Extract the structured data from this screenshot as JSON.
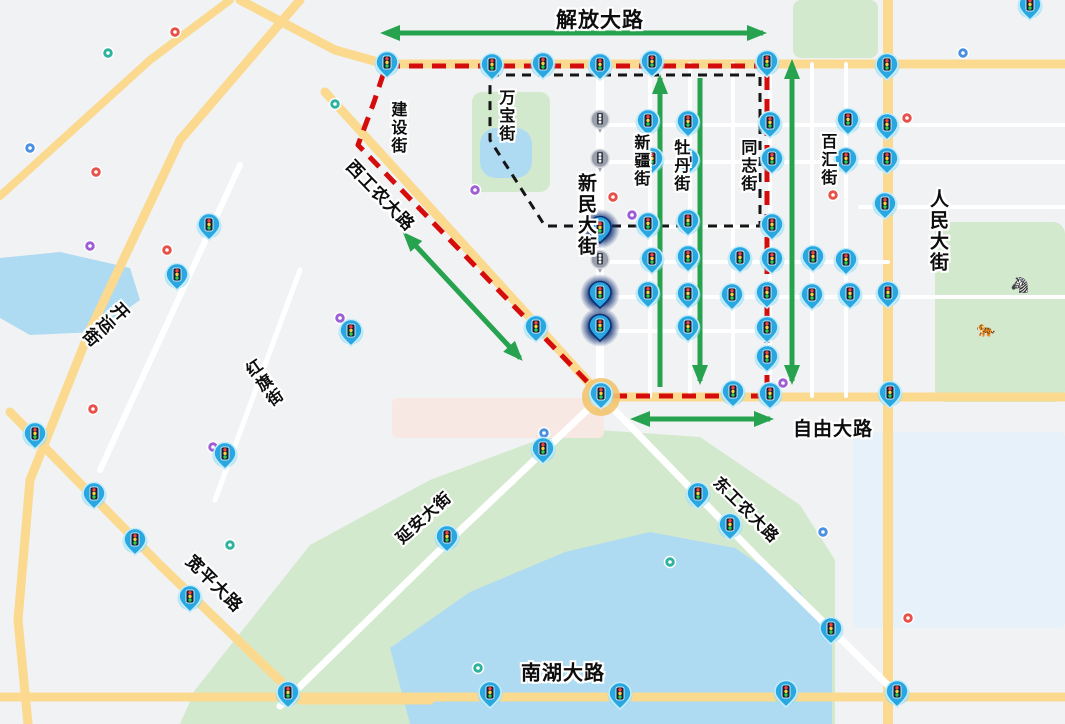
{
  "map": {
    "colors": {
      "bg": "#f1f2f4",
      "road_yellow": "#fbd98f",
      "road_white": "#ffffff",
      "park": "#d3e9cd",
      "water": "#aedaf2",
      "campus": "#e6f1fa",
      "pink_zone": "#f8e8e4",
      "route_red": "#d40c0c",
      "route_black": "#151515",
      "arrow_green": "#27a24e",
      "pin_blue": "#28a7e1",
      "pin_blue_dark": "#1286c6",
      "pin_halo": "#8edcf6",
      "pin_gray": "#99a0ab",
      "glow_navy": "#0d2f73",
      "roundabout_ring": "#f3c56f",
      "light_red": "#ff4338",
      "light_yellow": "#ffcf33",
      "light_green": "#35cc43",
      "poi_red": "#e8504a",
      "poi_teal": "#2db39e",
      "poi_blue": "#4a90e2",
      "poi_purple": "#9d5fd3"
    },
    "areas": [
      {
        "shape": "polygon",
        "points": "180,724 195,690 310,545 430,480 570,428 700,437 800,505 835,560 835,724",
        "fill": "park"
      },
      {
        "shape": "polygon",
        "points": "390,648 470,592 565,552 650,532 735,548 800,592 832,645 832,724 410,724",
        "fill": "water"
      },
      {
        "shape": "rect",
        "x": 935,
        "y": 222,
        "w": 130,
        "h": 180,
        "rx": 12,
        "fill": "park"
      },
      {
        "shape": "rect",
        "x": 793,
        "y": 0,
        "w": 85,
        "h": 58,
        "rx": 8,
        "fill": "park"
      },
      {
        "shape": "rect",
        "x": 472,
        "y": 92,
        "w": 78,
        "h": 100,
        "rx": 10,
        "fill": "park"
      },
      {
        "shape": "rect",
        "x": 480,
        "y": 128,
        "w": 52,
        "h": 50,
        "rx": 16,
        "fill": "water"
      },
      {
        "shape": "polygon",
        "points": "0,258 60,252 130,268 140,300 95,332 30,335 0,318",
        "fill": "water"
      },
      {
        "shape": "rect",
        "x": 853,
        "y": 432,
        "w": 212,
        "h": 196,
        "rx": 6,
        "fill": "campus"
      },
      {
        "shape": "rect",
        "x": 392,
        "y": 398,
        "w": 212,
        "h": 40,
        "rx": 6,
        "fill": "pink_zone"
      }
    ],
    "roads": [
      {
        "points": "240,0 335,50 385,64 1065,64",
        "w": 9,
        "c": "road_yellow"
      },
      {
        "points": "300,0 180,140 90,330 30,480 18,620 28,724",
        "w": 9,
        "c": "road_yellow"
      },
      {
        "points": "0,196 150,60 230,0",
        "w": 8,
        "c": "road_yellow"
      },
      {
        "points": "10,412 160,565 300,700 430,700",
        "w": 9,
        "c": "road_yellow"
      },
      {
        "points": "325,92 601,396",
        "w": 9,
        "c": "road_yellow"
      },
      {
        "points": "888,0 888,724",
        "w": 10,
        "c": "road_yellow"
      },
      {
        "points": "601,397 1065,397",
        "w": 9,
        "c": "road_yellow"
      },
      {
        "points": "0,697 1065,697",
        "w": 9,
        "c": "road_yellow"
      },
      {
        "points": "601,396 760,560 900,697",
        "w": 7,
        "c": "road_white"
      },
      {
        "points": "280,706 450,540 601,397",
        "w": 7,
        "c": "road_white"
      },
      {
        "points": "600,64 600,396",
        "w": 8,
        "c": "road_white"
      },
      {
        "points": "650,64 650,396",
        "w": 4,
        "c": "road_white"
      },
      {
        "points": "690,64 690,396",
        "w": 4,
        "c": "road_white"
      },
      {
        "points": "733,64 733,396",
        "w": 4,
        "c": "road_white"
      },
      {
        "points": "770,64 770,396",
        "w": 4,
        "c": "road_white"
      },
      {
        "points": "812,64 812,396",
        "w": 4,
        "c": "road_white"
      },
      {
        "points": "846,64 846,396",
        "w": 4,
        "c": "road_white"
      },
      {
        "points": "600,125 1065,125",
        "w": 4,
        "c": "road_white"
      },
      {
        "points": "600,162 1065,162",
        "w": 4,
        "c": "road_white"
      },
      {
        "points": "860,207 1065,207",
        "w": 4,
        "c": "road_white"
      },
      {
        "points": "600,227 770,227",
        "w": 4,
        "c": "road_white"
      },
      {
        "points": "600,262 888,262",
        "w": 4,
        "c": "road_white"
      },
      {
        "points": "600,297 1065,297",
        "w": 4,
        "c": "road_white"
      },
      {
        "points": "600,331 770,331",
        "w": 4,
        "c": "road_white"
      },
      {
        "points": "300,270 215,500",
        "w": 5,
        "c": "road_white"
      },
      {
        "points": "240,165 100,470",
        "w": 6,
        "c": "road_white"
      }
    ],
    "red_route": "386,66 767,66 767,396 601,396 358,145 374,102 386,66",
    "black_route": "490,75 760,75 760,226 545,226 490,140 490,75",
    "arrows": [
      {
        "x1": 398,
        "y1": 33,
        "x2": 763,
        "y2": 33,
        "head_start": true,
        "head_end": true
      },
      {
        "x1": 415,
        "y1": 245,
        "x2": 520,
        "y2": 358,
        "head_start": true,
        "head_end": true
      },
      {
        "x1": 660,
        "y1": 387,
        "x2": 660,
        "y2": 78,
        "head_start": false,
        "head_end": true
      },
      {
        "x1": 700,
        "y1": 78,
        "x2": 700,
        "y2": 381,
        "head_start": false,
        "head_end": true
      },
      {
        "x1": 792,
        "y1": 77,
        "x2": 792,
        "y2": 381,
        "head_start": true,
        "head_end": true
      },
      {
        "x1": 648,
        "y1": 419,
        "x2": 770,
        "y2": 419,
        "head_start": true,
        "head_end": true
      }
    ],
    "street_labels": [
      {
        "text": "解放大路",
        "x": 600,
        "y": 21,
        "mode": "h",
        "rot": 0,
        "size": 21
      },
      {
        "text": "建设街",
        "x": 396,
        "y": 128,
        "mode": "v",
        "rot": 0,
        "size": 16
      },
      {
        "text": "万宝街",
        "x": 504,
        "y": 116,
        "mode": "v",
        "rot": 0,
        "size": 16
      },
      {
        "text": "西工农大路",
        "x": 380,
        "y": 196,
        "mode": "h",
        "rot": 46,
        "size": 17
      },
      {
        "text": "新民大街",
        "x": 585,
        "y": 215,
        "mode": "v",
        "rot": 0,
        "size": 19
      },
      {
        "text": "新疆街",
        "x": 639,
        "y": 161,
        "mode": "v",
        "rot": 0,
        "size": 16
      },
      {
        "text": "牡丹街",
        "x": 679,
        "y": 166,
        "mode": "v",
        "rot": 0,
        "size": 16
      },
      {
        "text": "同志街",
        "x": 746,
        "y": 166,
        "mode": "v",
        "rot": 0,
        "size": 16
      },
      {
        "text": "百汇街",
        "x": 826,
        "y": 160,
        "mode": "v",
        "rot": 0,
        "size": 16
      },
      {
        "text": "人民大街",
        "x": 937,
        "y": 231,
        "mode": "v",
        "rot": 0,
        "size": 19
      },
      {
        "text": "开运街",
        "x": 104,
        "y": 323,
        "mode": "v",
        "rot": 48,
        "size": 17
      },
      {
        "text": "红旗街",
        "x": 262,
        "y": 385,
        "mode": "v",
        "rot": -35,
        "size": 16
      },
      {
        "text": "自由大路",
        "x": 833,
        "y": 430,
        "mode": "h",
        "rot": 0,
        "size": 19
      },
      {
        "text": "东工农大路",
        "x": 745,
        "y": 511,
        "mode": "h",
        "rot": 45,
        "size": 16
      },
      {
        "text": "延安大街",
        "x": 425,
        "y": 519,
        "mode": "h",
        "rot": -42,
        "size": 16
      },
      {
        "text": "宽平大路",
        "x": 214,
        "y": 584,
        "mode": "h",
        "rot": 45,
        "size": 17
      },
      {
        "text": "南湖大路",
        "x": 563,
        "y": 674,
        "mode": "h",
        "rot": 0,
        "size": 20
      }
    ],
    "markers": {
      "blue": [
        [
          387,
          66
        ],
        [
          492,
          68
        ],
        [
          543,
          67
        ],
        [
          600,
          68
        ],
        [
          652,
          65
        ],
        [
          767,
          65
        ],
        [
          887,
          68
        ],
        [
          1030,
          8
        ],
        [
          648,
          124
        ],
        [
          688,
          125
        ],
        [
          770,
          126
        ],
        [
          848,
          123
        ],
        [
          887,
          128
        ],
        [
          652,
          162
        ],
        [
          688,
          163
        ],
        [
          772,
          162
        ],
        [
          846,
          162
        ],
        [
          887,
          162
        ],
        [
          885,
          207
        ],
        [
          648,
          227
        ],
        [
          688,
          224
        ],
        [
          772,
          228
        ],
        [
          652,
          262
        ],
        [
          688,
          260
        ],
        [
          740,
          261
        ],
        [
          772,
          262
        ],
        [
          813,
          260
        ],
        [
          846,
          263
        ],
        [
          648,
          296
        ],
        [
          688,
          297
        ],
        [
          732,
          298
        ],
        [
          767,
          296
        ],
        [
          812,
          298
        ],
        [
          850,
          297
        ],
        [
          888,
          296
        ],
        [
          536,
          330
        ],
        [
          688,
          330
        ],
        [
          767,
          331
        ],
        [
          767,
          360
        ],
        [
          601,
          397
        ],
        [
          733,
          395
        ],
        [
          770,
          397
        ],
        [
          890,
          396
        ],
        [
          209,
          228
        ],
        [
          177,
          278
        ],
        [
          351,
          334
        ],
        [
          35,
          437
        ],
        [
          225,
          457
        ],
        [
          94,
          497
        ],
        [
          135,
          543
        ],
        [
          190,
          600
        ],
        [
          288,
          696
        ],
        [
          490,
          696
        ],
        [
          620,
          697
        ],
        [
          786,
          695
        ],
        [
          897,
          695
        ],
        [
          543,
          452
        ],
        [
          447,
          540
        ],
        [
          698,
          497
        ],
        [
          730,
          528
        ],
        [
          831,
          632
        ]
      ],
      "gray": [
        [
          600,
          123
        ],
        [
          600,
          162
        ],
        [
          600,
          263
        ]
      ],
      "glow": [
        [
          600,
          231
        ],
        [
          600,
          296
        ],
        [
          600,
          329
        ]
      ]
    },
    "roundabout": {
      "x": 601,
      "y": 397
    },
    "poi_dots": [
      [
        175,
        32,
        "poi_red"
      ],
      [
        108,
        53,
        "poi_teal"
      ],
      [
        30,
        148,
        "poi_blue"
      ],
      [
        96,
        172,
        "poi_red"
      ],
      [
        90,
        246,
        "poi_purple"
      ],
      [
        335,
        104,
        "poi_teal"
      ],
      [
        475,
        190,
        "poi_purple"
      ],
      [
        167,
        250,
        "poi_red"
      ],
      [
        613,
        197,
        "poi_red"
      ],
      [
        632,
        215,
        "poi_purple"
      ],
      [
        833,
        195,
        "poi_red"
      ],
      [
        340,
        318,
        "poi_purple"
      ],
      [
        93,
        409,
        "poi_red"
      ],
      [
        213,
        447,
        "poi_purple"
      ],
      [
        230,
        545,
        "poi_teal"
      ],
      [
        544,
        433,
        "poi_blue"
      ],
      [
        783,
        383,
        "poi_purple"
      ],
      [
        907,
        118,
        "poi_red"
      ],
      [
        963,
        53,
        "poi_blue"
      ],
      [
        908,
        618,
        "poi_red"
      ],
      [
        670,
        562,
        "poi_teal"
      ],
      [
        478,
        668,
        "poi_teal"
      ],
      [
        823,
        532,
        "poi_blue"
      ]
    ],
    "zoo_icons": [
      {
        "glyph": "🦓",
        "x": 1020,
        "y": 290
      },
      {
        "glyph": "🐅",
        "x": 986,
        "y": 334
      }
    ]
  }
}
